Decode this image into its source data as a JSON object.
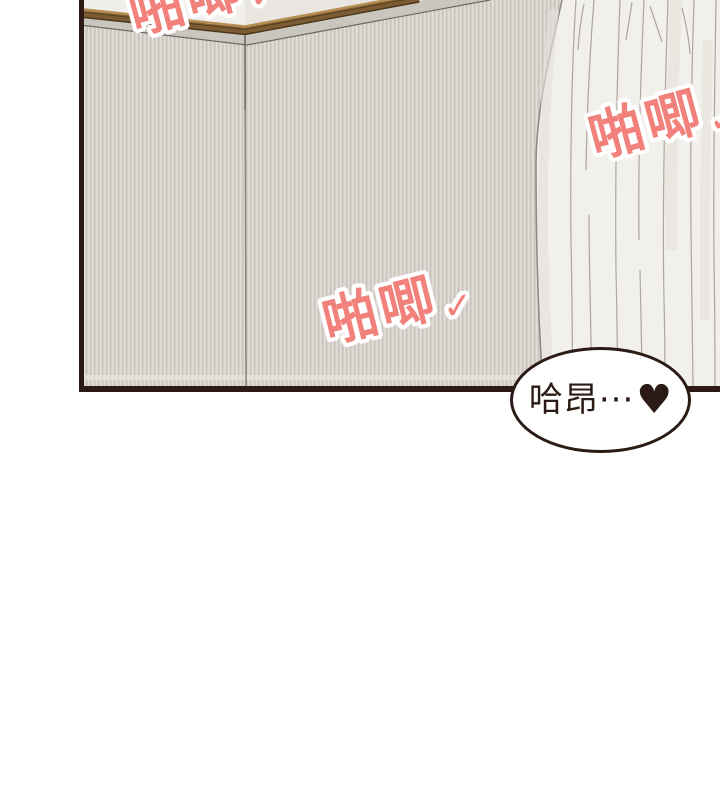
{
  "panel": {
    "border_color": "#2e1a14",
    "wall_base_color": "#d6d1ca",
    "wall_stripe_light": "#e1ddd7",
    "wall_stripe_dark": "#c7c2bb",
    "molding_color": "#7d5c33",
    "ceiling_color": "#f1efec",
    "curtain_color": "#f2f0ec",
    "curtain_line_color": "#a59f96"
  },
  "sfx": [
    {
      "text": "啪唧",
      "check": "✓",
      "color": "#f2817b"
    },
    {
      "text": "啪唧",
      "check": "✓",
      "color": "#f2817b"
    },
    {
      "text": "啪唧",
      "check": "✓",
      "color": "#f2817b"
    }
  ],
  "speech_bubble": {
    "text": "哈昂···",
    "heart": "♥",
    "text_color": "#2b1a15",
    "border_color": "#2b1a15",
    "fill": "#ffffff"
  }
}
